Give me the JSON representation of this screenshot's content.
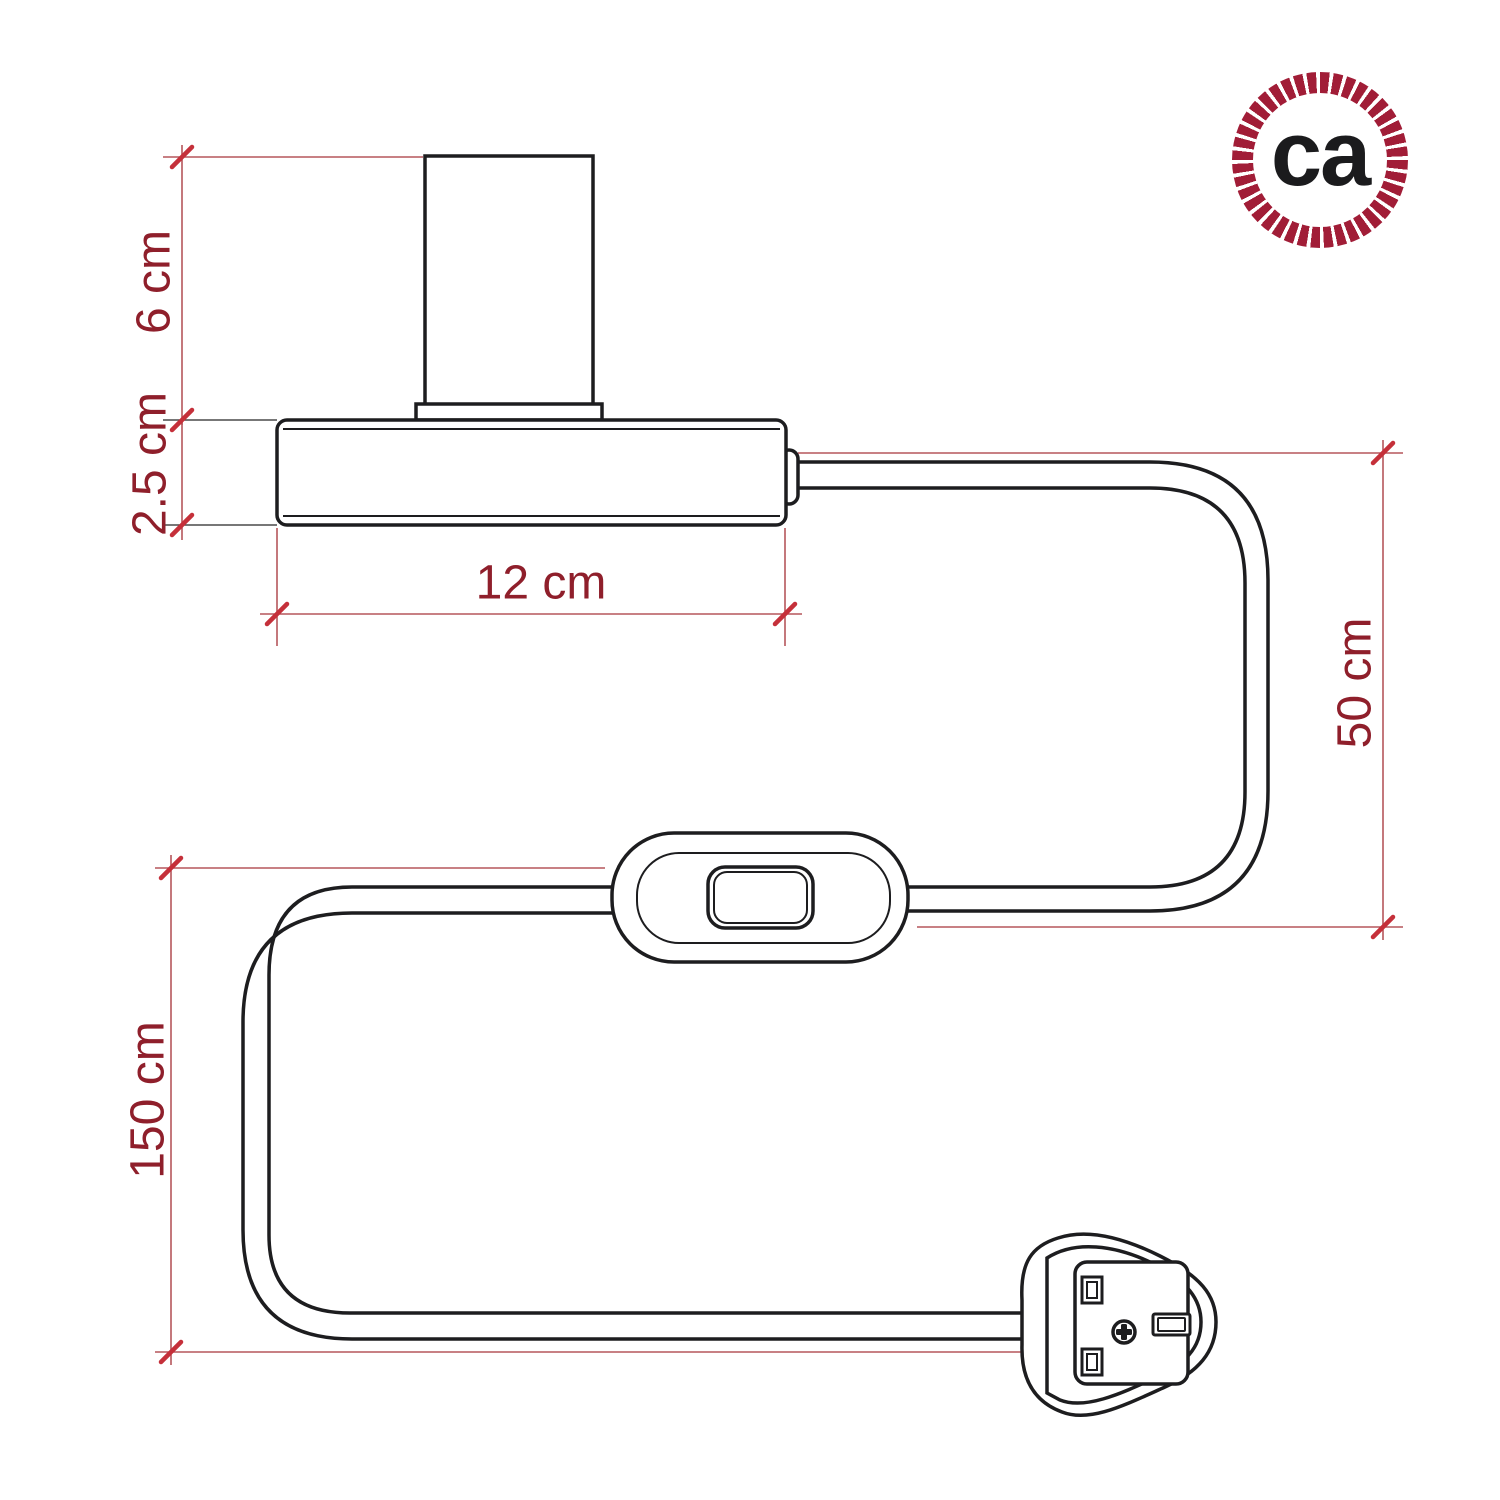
{
  "page": {
    "type": "product-dimension-diagram"
  },
  "logo": {
    "text": "ca"
  },
  "dimensions": {
    "socket_height": {
      "label": "6 cm",
      "value": 6,
      "unit": "cm"
    },
    "base_thickness": {
      "label": "2.5 cm",
      "value": 2.5,
      "unit": "cm"
    },
    "base_width": {
      "label": "12 cm",
      "value": 12,
      "unit": "cm"
    },
    "cable_base_to_switch": {
      "label": "50 cm",
      "value": 50,
      "unit": "cm"
    },
    "cable_switch_to_plug": {
      "label": "150 cm",
      "value": 150,
      "unit": "cm"
    }
  },
  "parts": {
    "lamp_holder": "lamp holder",
    "base": "flat base",
    "switch": "inline rocker switch",
    "plug": "UK fused plug",
    "cable": "power cable"
  },
  "colors": {
    "line_art": "#1d1d1f",
    "dimension_line": "#b5565c",
    "tick": "#c5303a",
    "dimension_text": "#8f1f2b",
    "logo_ring": "#a11d37",
    "logo_text": "#1b1b1d",
    "background": "#ffffff"
  }
}
